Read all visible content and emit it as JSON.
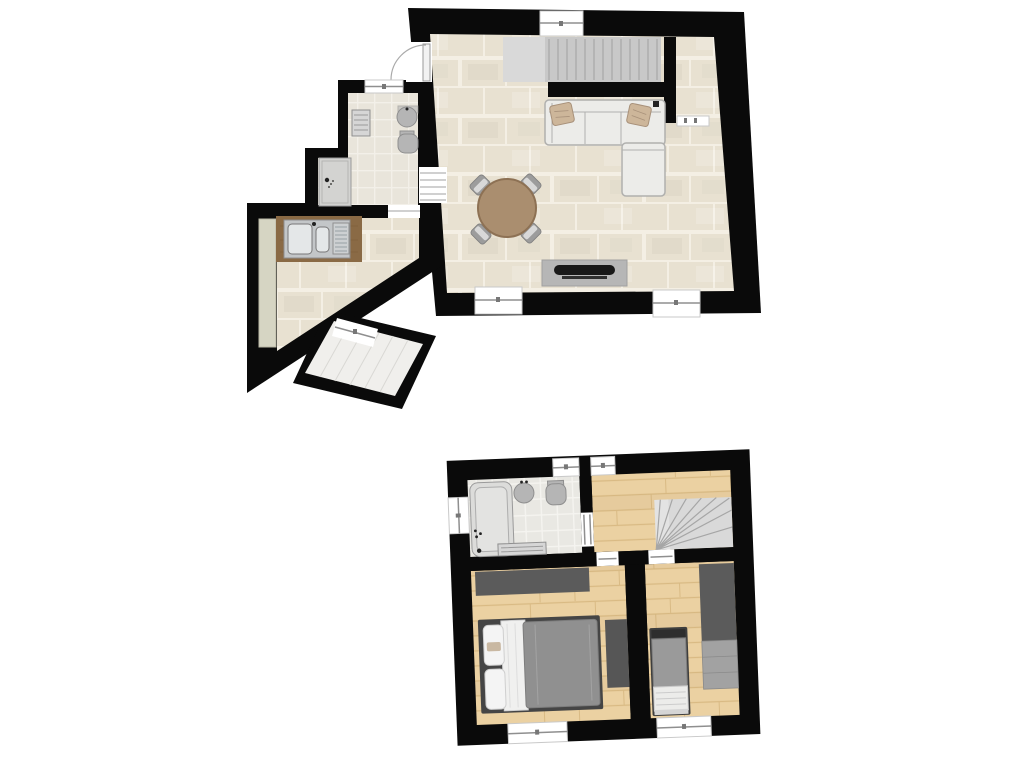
{
  "canvas": {
    "width": 1024,
    "height": 768,
    "background": "#ffffff"
  },
  "colors": {
    "bg": "#ffffff",
    "wall": "#0a0a0a",
    "floor_tile": "#e8e1d1",
    "tile_grout": "#f4efe4",
    "bath_tile": "#e9e5db",
    "bath_grout": "#f3f0e9",
    "bath2_tile": "#e9e8e3",
    "bath2_grout": "#f5f4f0",
    "wood": "#ebd1a2",
    "wood_line": "#d9ba84",
    "stair": "#c8c8c8",
    "stair_light": "#d9d9d9",
    "stair_line": "#a6a6a6",
    "sofa": "#ecece9",
    "sofa_line": "#b0b0ae",
    "pillow": "#cdb69a",
    "pillow_line": "#a8917a",
    "table": "#aa8e6f",
    "table_rim": "#8d7154",
    "chair": "#9c9c9c",
    "chair_light": "#d8d8d8",
    "tv_unit": "#b6b6b6",
    "tv": "#181818",
    "counter": "#8a6a45",
    "steel": "#c3c6c8",
    "basin": "#e4e7e8",
    "cabinet": "#d6d5c3",
    "shower": "#d3d3d1",
    "fixture": "#b5b5b5",
    "radiator": "#d6d6d6",
    "window_line": "#8f8f8f",
    "tub": "#dcdcda",
    "wardrobe": "#5b5b5b",
    "rug": "#565656",
    "bed_frame": "#454545",
    "duvet": "#909090",
    "blanket": "#f0f0ef",
    "dresser": "#a2a2a2",
    "door": "#f2f2f2"
  },
  "plan": {
    "floors": 2,
    "lower_plan_rotation_deg": -2.2
  }
}
